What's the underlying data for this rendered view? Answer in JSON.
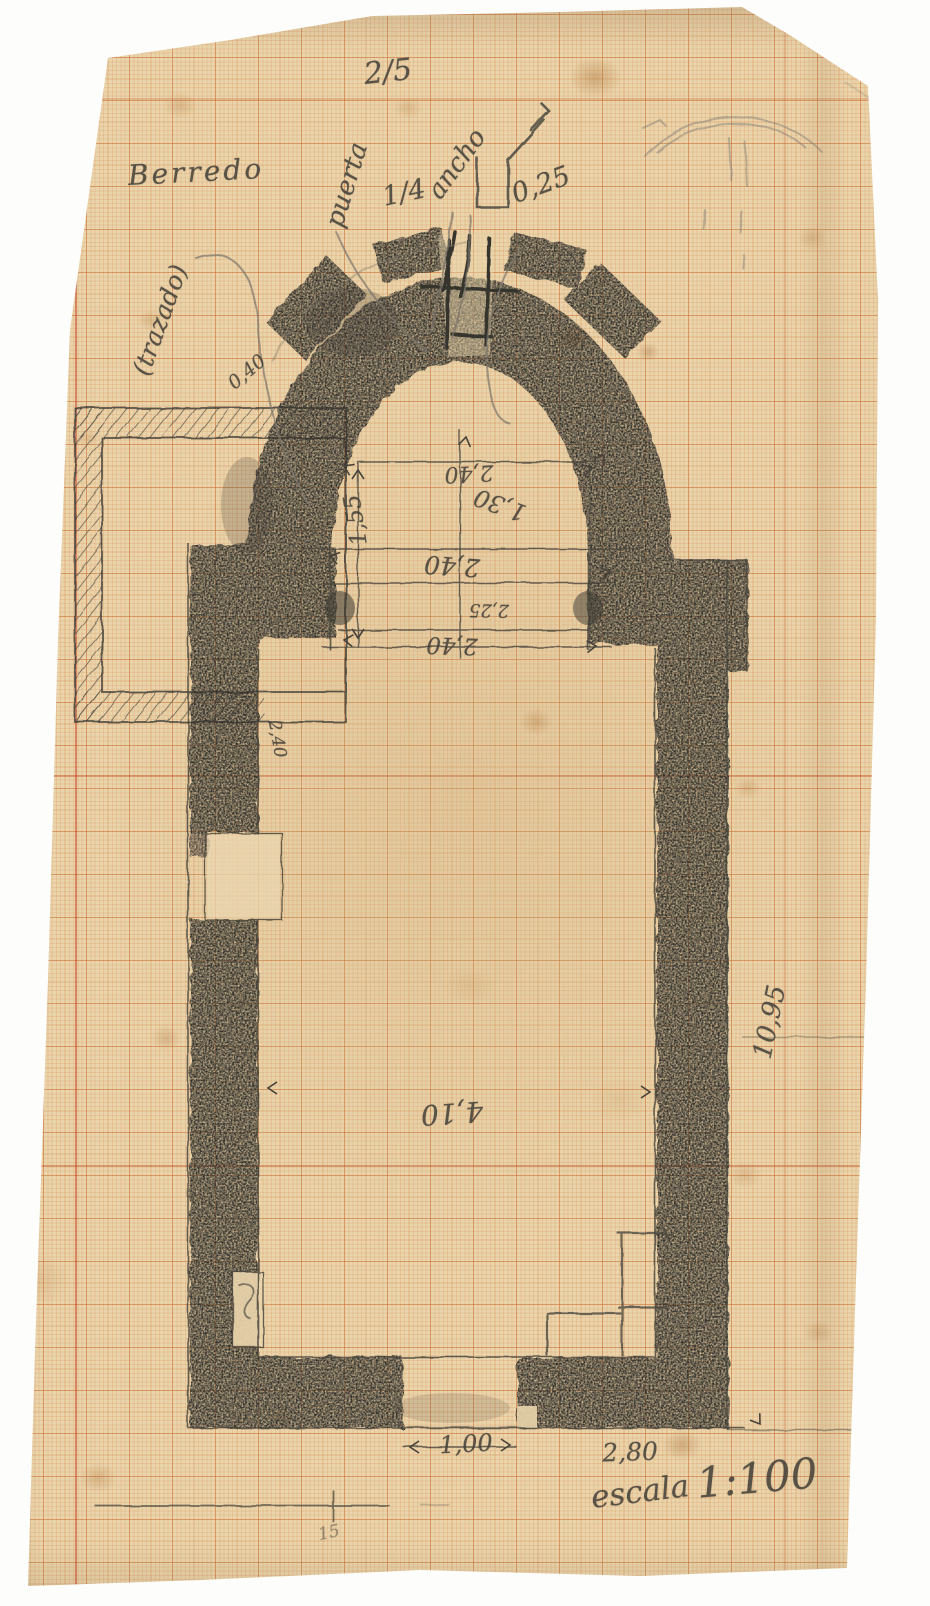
{
  "sheet": {
    "number": "2/5",
    "title": "Berredo",
    "scale_word": "escala",
    "scale_value": "1:100"
  },
  "apse_notes": {
    "puerta": "puerta",
    "one_quarter": "1/4",
    "ancho": "ancho",
    "jamb_dim": "0,25",
    "trazado": "(trazado)",
    "wall_thickness": "0,40"
  },
  "chancel_dims": {
    "width_top": "2,40",
    "radius": "1,30",
    "depth_left": "1,55",
    "width_mid": "2,40",
    "arch_span": "2,25",
    "width_bottom": "2,40"
  },
  "nave_dims": {
    "left_wall": "2,40",
    "width": "4,10",
    "length": "10,95",
    "entrance_width": "1,00",
    "entrance_offset": "2,80"
  },
  "margin_marks": {
    "bottom_note": "15",
    "edge_letter": "a",
    "edge_cross": "+"
  },
  "colors": {
    "paper": "#e9d4ab",
    "grid_fine": "#dba06a",
    "grid_major": "#c87c42",
    "pencil_dark": "#34322c",
    "pencil_light": "#6a6458",
    "ink_text": "#45413a"
  }
}
